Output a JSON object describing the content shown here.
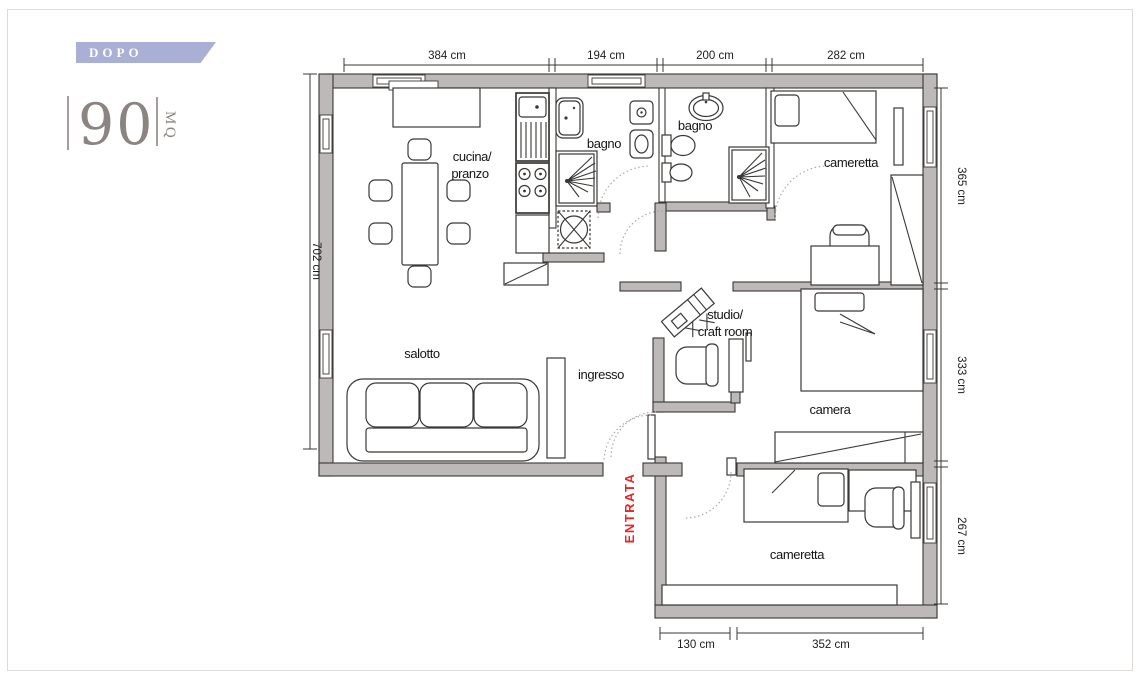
{
  "ribbon": {
    "label": "DOPO"
  },
  "area_badge": {
    "value": "90",
    "unit": "MQ"
  },
  "plan": {
    "rooms": {
      "kitchen_line1": "cucina/",
      "kitchen_line2": "pranzo",
      "bathroom1": "bagno",
      "bathroom2": "bagno",
      "kids_bedroom_top": "cameretta",
      "living_room": "salotto",
      "entry_hall": "ingresso",
      "studio_line1": "studio/",
      "studio_line2": "craft room",
      "master_bedroom": "camera",
      "kids_bedroom_bottom": "cameretta",
      "entrance": "ENTRATA"
    },
    "dimensions": {
      "top": [
        "384 cm",
        "194 cm",
        "200 cm",
        "282 cm"
      ],
      "left": [
        "702 cm"
      ],
      "right": [
        "365 cm",
        "333 cm",
        "267 cm"
      ],
      "bottom": [
        "130 cm",
        "352 cm"
      ]
    }
  },
  "colors": {
    "ribbon_bg": "#a9afd5",
    "ribbon_text": "#ffffff",
    "area_text": "#8b8481",
    "wall_fill": "#bcb9b8",
    "line": "#3a3836",
    "entrance_red": "#e62629",
    "door_arc": "#a5a2a0"
  }
}
